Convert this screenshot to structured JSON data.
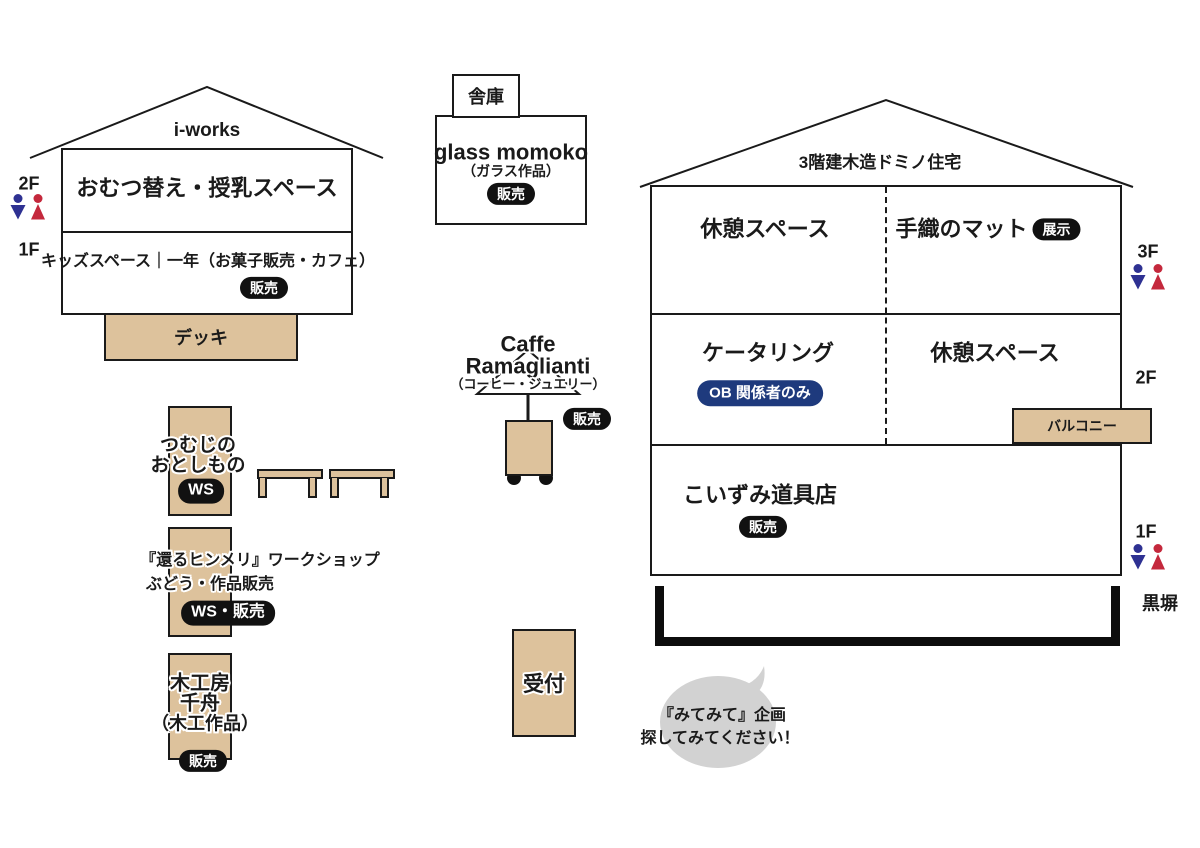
{
  "colors": {
    "tan": "#ddc29c",
    "line_black": "#1a1a1a",
    "badge_black": "#111111",
    "badge_navy": "#1e3a7d",
    "restroom_male_blue": "#2e3192",
    "restroom_female_red": "#c4283c",
    "bubble_gray": "#d2d2d2"
  },
  "left_building": {
    "roof_label": "i-works",
    "floor2_label": "2F",
    "floor1_label": "1F",
    "room_2f": "おむつ替え・授乳スペース",
    "room_1f": "キッズスペース｜一年（お菓子販売・カフェ）",
    "room_1f_badge": "販売",
    "deck_label": "デッキ"
  },
  "storage": {
    "label": "舎庫"
  },
  "glass_momoko": {
    "title": "glass momoko",
    "subtitle": "（ガラス作品）",
    "badge": "販売"
  },
  "right_building": {
    "roof_label": "3階建木造ドミノ住宅",
    "floor3_label": "3F",
    "floor2_label": "2F",
    "floor1_label": "1F",
    "room_3f_left": "休憩スペース",
    "room_3f_right": "手織のマット",
    "room_3f_right_badge": "展示",
    "room_2f_left": "ケータリング",
    "room_2f_left_badge": "OB 関係者のみ",
    "room_2f_right": "休憩スペース",
    "balcony_label": "バルコニー",
    "room_1f": "こいずみ道具店",
    "room_1f_badge": "販売",
    "fence_label": "黒塀"
  },
  "caffe": {
    "title_line1": "Caffe",
    "title_line2": "Ramaglianti",
    "subtitle": "（コーヒー・ジュエリー）",
    "badge": "販売"
  },
  "booths": {
    "tsumuji": {
      "line1": "つむじの",
      "line2": "おとしもの",
      "badge": "WS"
    },
    "himmeli": {
      "line1": "『還るヒンメリ』ワークショップ",
      "line2": "ぶどう・作品販売",
      "badge": "WS・販売"
    },
    "mokkobo": {
      "line1": "木工房",
      "line2": "千舟",
      "line3": "（木工作品）",
      "badge": "販売"
    }
  },
  "reception": {
    "label": "受付"
  },
  "note_bubble": {
    "line1": "『みてみて』企画",
    "line2": "探してみてください！"
  }
}
